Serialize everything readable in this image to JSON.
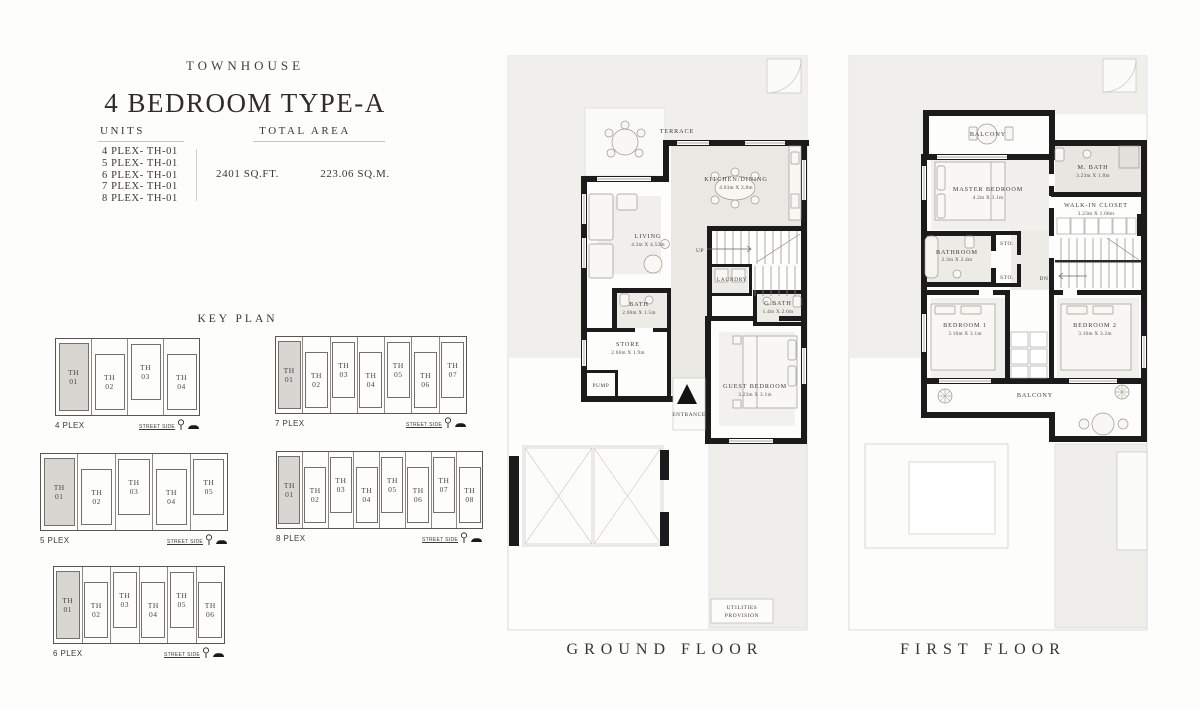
{
  "header": {
    "brand": "TOWNHOUSE",
    "title": "4 BEDROOM TYPE-A",
    "units_label": "UNITS",
    "total_area_label": "TOTAL AREA",
    "units": [
      "4 PLEX- TH-01",
      "5 PLEX- TH-01",
      "6 PLEX- TH-01",
      "7 PLEX- TH-01",
      "8 PLEX- TH-01"
    ],
    "area_sqft": "2401 SQ.FT.",
    "area_sqm": "223.06 SQ.M."
  },
  "key_plan": {
    "title": "KEY PLAN",
    "street_side_label": "STREET SIDE",
    "icons": [
      "tree-icon",
      "car-icon"
    ],
    "plexes": [
      {
        "label": "4 PLEX",
        "highlighted": 0,
        "units": [
          "TH 01",
          "TH 02",
          "TH 03",
          "TH 04"
        ]
      },
      {
        "label": "7 PLEX",
        "highlighted": 0,
        "units": [
          "TH 01",
          "TH 02",
          "TH 03",
          "TH 04",
          "TH 05",
          "TH 06",
          "TH 07"
        ]
      },
      {
        "label": "5 PLEX",
        "highlighted": 0,
        "units": [
          "TH 01",
          "TH 02",
          "TH 03",
          "TH 04",
          "TH 05"
        ]
      },
      {
        "label": "8 PLEX",
        "highlighted": 0,
        "units": [
          "TH 01",
          "TH 02",
          "TH 03",
          "TH 04",
          "TH 05",
          "TH 06",
          "TH 07",
          "TH 08"
        ]
      },
      {
        "label": "6 PLEX",
        "highlighted": 0,
        "units": [
          "TH 01",
          "TH 02",
          "TH 03",
          "TH 04",
          "TH 05",
          "TH 06"
        ]
      }
    ]
  },
  "ground_floor": {
    "title": "GROUND FLOOR",
    "rooms": {
      "terrace": {
        "name": "TERRACE"
      },
      "kitchen": {
        "name": "KITCHEN/DINING",
        "dims": "4.63m X 3.8m"
      },
      "living": {
        "name": "LIVING",
        "dims": "4.2m X 4.53m"
      },
      "up_label": "UP",
      "laundry": {
        "name": "LAUNDRY"
      },
      "bath": {
        "name": "BATH",
        "dims": "2.66m X 1.5m"
      },
      "gbath": {
        "name": "G.BATH",
        "dims": "1.4m X 2.6m"
      },
      "store": {
        "name": "STORE",
        "dims": "2.66m X 1.9m"
      },
      "pump": {
        "name": "PUMP"
      },
      "entrance": {
        "name": "ENTRANCE"
      },
      "guest": {
        "name": "GUEST BEDROOM",
        "dims": "3.23m X 3.1m"
      },
      "utilities_line1": "UTILITIES",
      "utilities_line2": "PROVISION"
    }
  },
  "first_floor": {
    "title": "FIRST FLOOR",
    "rooms": {
      "balcony_top": {
        "name": "BALCONY"
      },
      "mbath": {
        "name": "M. BATH",
        "dims": "3.23m X 1.8m"
      },
      "master": {
        "name": "MASTER BEDROOM",
        "dims": "4.2m X 3.1m"
      },
      "closet": {
        "name": "WALK-IN CLOSET",
        "dims": "3.23m X 1.68m"
      },
      "bathroom": {
        "name": "BATHROOM",
        "dims": "2.3m X 2.4m"
      },
      "sto_label": "STO.",
      "dn_label": "DN.",
      "bedroom1": {
        "name": "BEDROOM 1",
        "dims": "3.16m X 3.1m"
      },
      "bedroom2": {
        "name": "BEDROOM 2",
        "dims": "3.16m X 3.2m"
      },
      "balcony_bottom": {
        "name": "BALCONY"
      }
    }
  },
  "colors": {
    "wall": "#1b1b1b",
    "plot": "#f0efeb",
    "room_tint": "#e9e8e2",
    "highlight_unit": "#d7d6d1",
    "text": "#3a3734"
  }
}
